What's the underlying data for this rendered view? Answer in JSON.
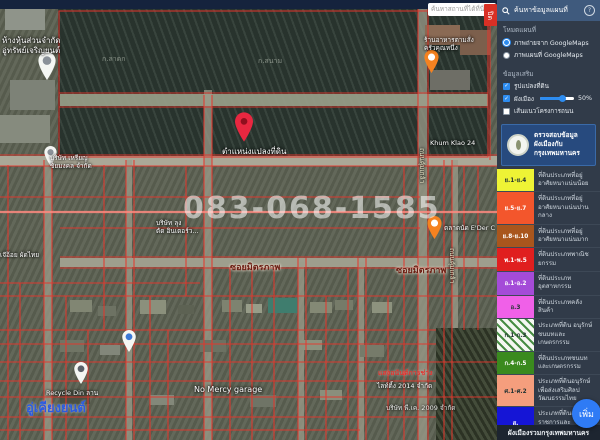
{
  "topbar": {
    "search_placeholder": "ค้นหาสถานที่ได้ที่นี่",
    "close_tab_label": "ปิด"
  },
  "watermark": "083-068-1585",
  "map_labels": [
    {
      "text": "ห้างหุ้นส่วนจำกัด\nอู่ทรัพย์เจริญยนต์"
    },
    {
      "text": "ก.ลาดก"
    },
    {
      "text": "ก.สนาม"
    },
    {
      "text": "Khum Klao 24"
    },
    {
      "text": "ถนนคุ้มเกล้า"
    },
    {
      "text": "บริษัท เหรียญ\nชัยมงคล จำกัด"
    },
    {
      "text": "บริษัท ลุง\nตัด อินเตอร์ว..."
    },
    {
      "text": "ซอยมิตรภาพ"
    },
    {
      "text": "ซอยมิตรภาพ"
    },
    {
      "text": "ตำแหน่งแปลงที่ดิน"
    },
    {
      "text": "ตลาดนัด E'Der C"
    },
    {
      "text": "Recycle Din ลาน"
    },
    {
      "text": "No Mercy garage"
    },
    {
      "text": "แสงอนันต์การช่าง"
    },
    {
      "text": "ไลท์ติ้ง 2014 จำกัด"
    },
    {
      "text": "บริษัท พี.เค. 2009 จำกัด"
    },
    {
      "text": "อู่เคียงยนต์"
    },
    {
      "text": "ร้านอาหารตามสั่ง\nครัวคุณหนึ่ง"
    },
    {
      "text": "ถนนคุ้มเกล้า"
    },
    {
      "text": "เจ๊อ้อย ผัดไทย"
    }
  ],
  "sidebar": {
    "title": "ค้นหาข้อมูลแผนที่",
    "help_label": "?",
    "mode_section": {
      "label": "โหมดแผนที่",
      "options": [
        {
          "label": "ภาพถ่ายจาก GoogleMaps",
          "selected": true
        },
        {
          "label": "ภาพแผนที่ GoogleMaps",
          "selected": false
        }
      ]
    },
    "extras_section": {
      "label": "ข้อมูลเสริม",
      "items": [
        {
          "label": "รูปแปลงที่ดิน",
          "checked": true
        },
        {
          "label": "ผังเมือง",
          "checked": true,
          "slider_value": "50%"
        },
        {
          "label": "เส้นแนวโครงการถนน",
          "checked": false
        }
      ]
    },
    "check_mark": "✓",
    "info_panel": {
      "line1": "ตรวจสอบข้อมูลผังเมืองกับ",
      "line2": "กรุงเทพมหานคร"
    },
    "legend": [
      {
        "code": "ย.1-ย.4",
        "color": "#eef335",
        "desc": "ที่ดินประเภทที่อยู่อาศัยหนาแน่นน้อย"
      },
      {
        "code": "ย.5-ย.7",
        "color": "#f3562c",
        "desc": "ที่ดินประเภทที่อยู่อาศัยหนาแน่นปานกลาง"
      },
      {
        "code": "ย.8-ย.10",
        "color": "#a9561d",
        "desc": "ที่ดินประเภทที่อยู่อาศัยหนาแน่นมาก"
      },
      {
        "code": "พ.1-พ.5",
        "color": "#e01f1f",
        "desc": "ที่ดินประเภทพาณิชยกรรม"
      },
      {
        "code": "อ.1-อ.2",
        "color": "#a44bd8",
        "desc": "ที่ดินประเภทอุตสาหกรรม"
      },
      {
        "code": "อ.3",
        "color": "#f060e8",
        "desc": "ที่ดินประเภทคลังสินค้า"
      },
      {
        "code": "ก.1-ก.3",
        "color": "#f5f8f2",
        "desc": "ประเภทที่ดิน อนุรักษ์ชนบทและเกษตรกรรม"
      },
      {
        "code": "ก.4-ก.5",
        "color": "#3a8a1e",
        "desc": "ที่ดินประเภทชนบทและเกษตรกรรม"
      },
      {
        "code": "ศ.1-ศ.2",
        "color": "#f59e7d",
        "desc": "ประเภทที่ดินอนุรักษ์เพื่อส่งเสริมศิลปวัฒนธรรมไทย"
      },
      {
        "code": "ส.",
        "color": "#1515d6",
        "desc": "ประเภทที่ดินสถาบันราชการและสาธารณูปการ"
      }
    ],
    "footer": "ผังเมืองรวมกรุงเทพมหานคร",
    "fab_label": "เพิ่ม"
  }
}
